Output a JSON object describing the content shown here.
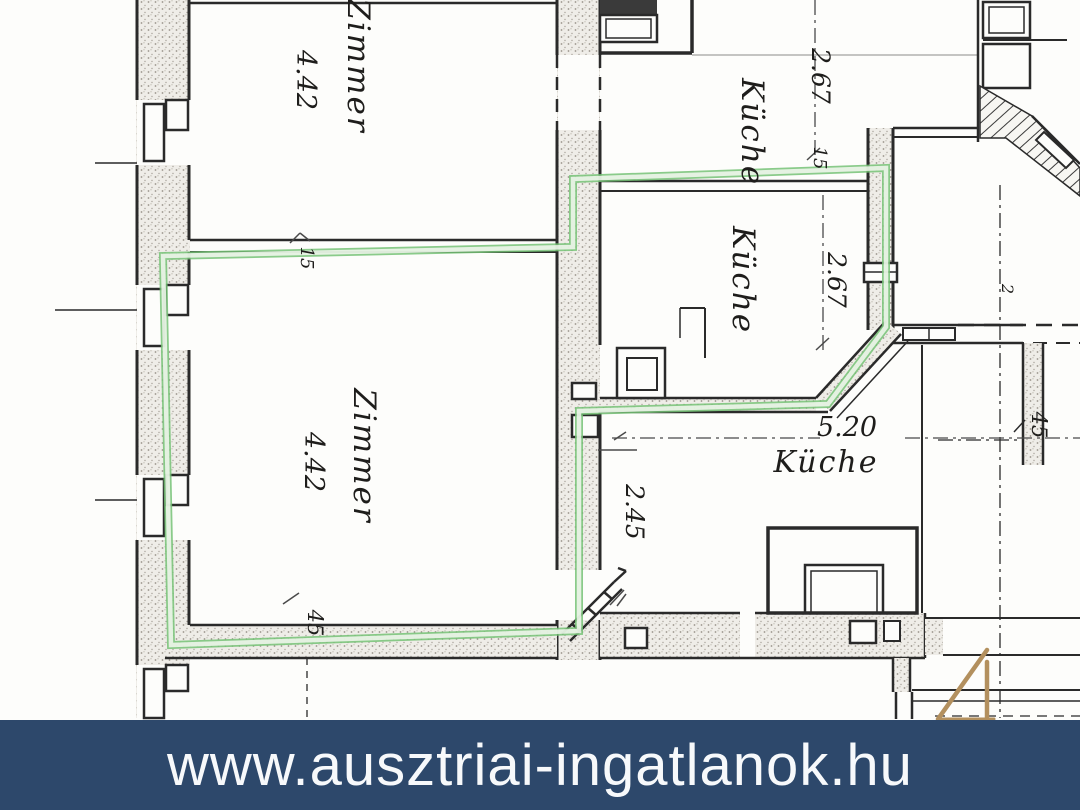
{
  "plan": {
    "rooms": [
      {
        "label": "Zimmer",
        "value": "4.42"
      },
      {
        "label": "Küche",
        "value": "2.67"
      },
      {
        "label": "Küche",
        "value": "2.67"
      },
      {
        "label": "Zimmer",
        "value": "4.42"
      },
      {
        "label": "Küche",
        "value": "5.20"
      }
    ],
    "dimensions": {
      "corridor_depth": "2.45",
      "wall_15_left": "15",
      "wall_15_right": "15",
      "wall_45_bottom": "45",
      "wall_45_right": "45",
      "small_mark": "2"
    },
    "colors": {
      "highlight": "#76c276",
      "ink": "#222222",
      "paper": "#fdfdfb"
    }
  },
  "corner_numeral": {
    "text": "4",
    "color": "#b3905e"
  },
  "watermark": {
    "url": "www.ausztriai-ingatlanok.hu",
    "background": "#2d486b",
    "text_color": "#f7f9fb"
  }
}
